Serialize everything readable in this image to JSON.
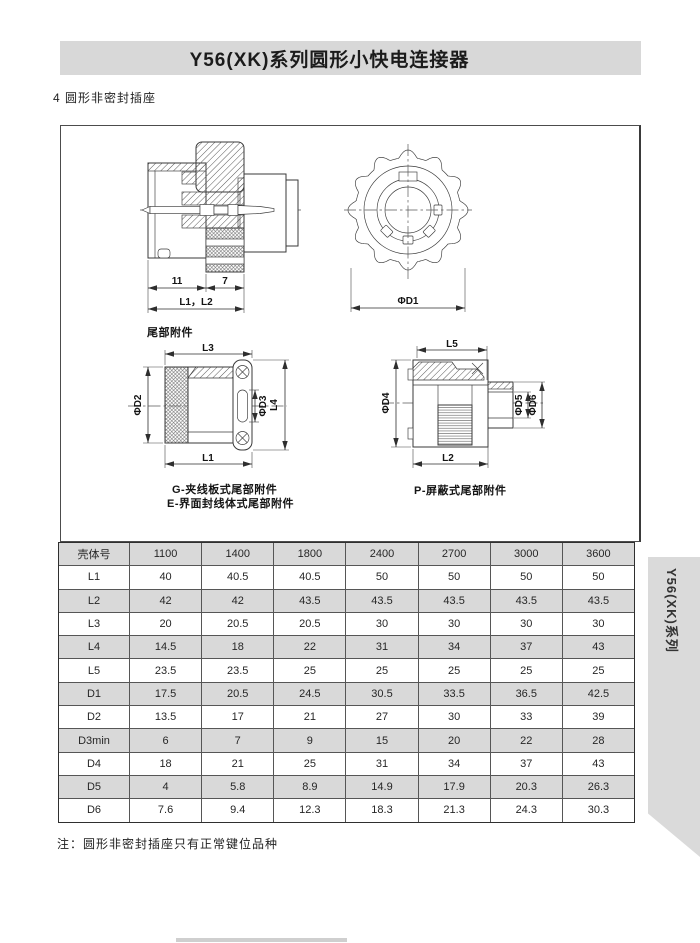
{
  "page": {
    "banner_title": "Y56(XK)系列圆形小快电连接器",
    "section_heading": "4 圆形非密封插座",
    "footnote": "注：圆形非密封插座只有正常键位品种",
    "side_tab_label": "Y56(XK)系列"
  },
  "drawings": {
    "section_view": {
      "dim_11": "11",
      "dim_7": "7",
      "dim_l1_l2": "L1，L2"
    },
    "front_view": {
      "dim_d1": "ΦD1"
    },
    "tail_attachment": {
      "title": "尾部附件",
      "dim_l3": "L3",
      "dim_phi_d2": "ΦD2",
      "dim_phi_d3": "ΦD3",
      "dim_l4": "L4",
      "dim_l1": "L1",
      "caption_g": "G-夹线板式尾部附件",
      "caption_e": "E-界面封线体式尾部附件"
    },
    "tail_shielded": {
      "dim_l5": "L5",
      "dim_phi_d4": "ΦD4",
      "dim_phi_d5": "ΦD5",
      "dim_phi_d6": "ΦD6",
      "dim_l2": "L2",
      "caption_p": "P-屏蔽式尾部附件"
    }
  },
  "table": {
    "header": [
      "壳体号",
      "1100",
      "1400",
      "1800",
      "2400",
      "2700",
      "3000",
      "3600"
    ],
    "rows": [
      {
        "label": "L1",
        "values": [
          "40",
          "40.5",
          "40.5",
          "50",
          "50",
          "50",
          "50"
        ]
      },
      {
        "label": "L2",
        "values": [
          "42",
          "42",
          "43.5",
          "43.5",
          "43.5",
          "43.5",
          "43.5"
        ]
      },
      {
        "label": "L3",
        "values": [
          "20",
          "20.5",
          "20.5",
          "30",
          "30",
          "30",
          "30"
        ]
      },
      {
        "label": "L4",
        "values": [
          "14.5",
          "18",
          "22",
          "31",
          "34",
          "37",
          "43"
        ]
      },
      {
        "label": "L5",
        "values": [
          "23.5",
          "23.5",
          "25",
          "25",
          "25",
          "25",
          "25"
        ]
      },
      {
        "label": "D1",
        "values": [
          "17.5",
          "20.5",
          "24.5",
          "30.5",
          "33.5",
          "36.5",
          "42.5"
        ]
      },
      {
        "label": "D2",
        "values": [
          "13.5",
          "17",
          "21",
          "27",
          "30",
          "33",
          "39"
        ]
      },
      {
        "label": "D3min",
        "values": [
          "6",
          "7",
          "9",
          "15",
          "20",
          "22",
          "28"
        ]
      },
      {
        "label": "D4",
        "values": [
          "18",
          "21",
          "25",
          "31",
          "34",
          "37",
          "43"
        ]
      },
      {
        "label": "D5",
        "values": [
          "4",
          "5.8",
          "8.9",
          "14.9",
          "17.9",
          "20.3",
          "26.3"
        ]
      },
      {
        "label": "D6",
        "values": [
          "7.6",
          "9.4",
          "12.3",
          "18.3",
          "21.3",
          "24.3",
          "30.3"
        ]
      }
    ]
  },
  "colors": {
    "banner_bg": "#d8d8d8",
    "row_alt_bg": "#d9d9d9",
    "tab_bg": "#dadada",
    "line": "#3a3a3a"
  }
}
